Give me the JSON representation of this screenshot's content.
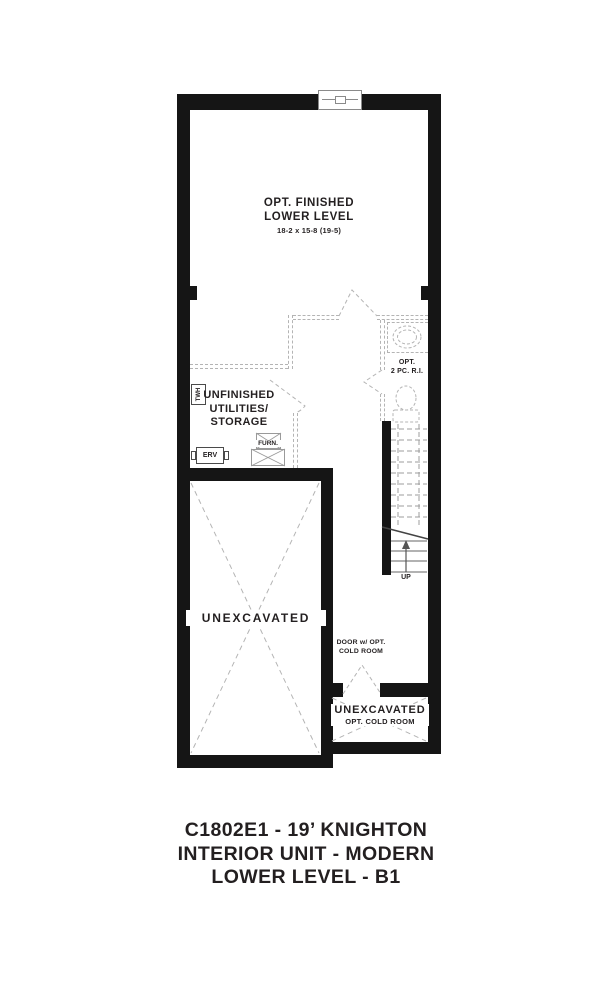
{
  "colors": {
    "wall": "#151515",
    "text": "#231f20",
    "dashed_line": "#b4b4b4",
    "stair_line": "#9c9c9c"
  },
  "finished_room": {
    "line1": "OPT. FINISHED",
    "line2": "LOWER LEVEL",
    "dims": "18-2 x 15-8 (19-5)"
  },
  "utility_room": {
    "line1": "UNFINISHED",
    "line2": "UTILITIES/",
    "line3": "STORAGE"
  },
  "equipment": {
    "twh": "TWH",
    "erv": "ERV",
    "furnace": "FURN."
  },
  "bathroom": {
    "line1": "OPT.",
    "line2": "2 PC. R.I."
  },
  "stairs": {
    "up_label": "UP"
  },
  "unexcavated_main": {
    "label": "UNEXCAVATED"
  },
  "cold_room": {
    "door_note_line1": "DOOR w/ OPT.",
    "door_note_line2": "COLD ROOM",
    "label": "UNEXCAVATED",
    "sub_label": "OPT. COLD ROOM"
  },
  "title_block": {
    "line1": "C1802E1 - 19’ KNIGHTON",
    "line2": "INTERIOR UNIT - MODERN",
    "line3": "LOWER LEVEL - B1"
  }
}
